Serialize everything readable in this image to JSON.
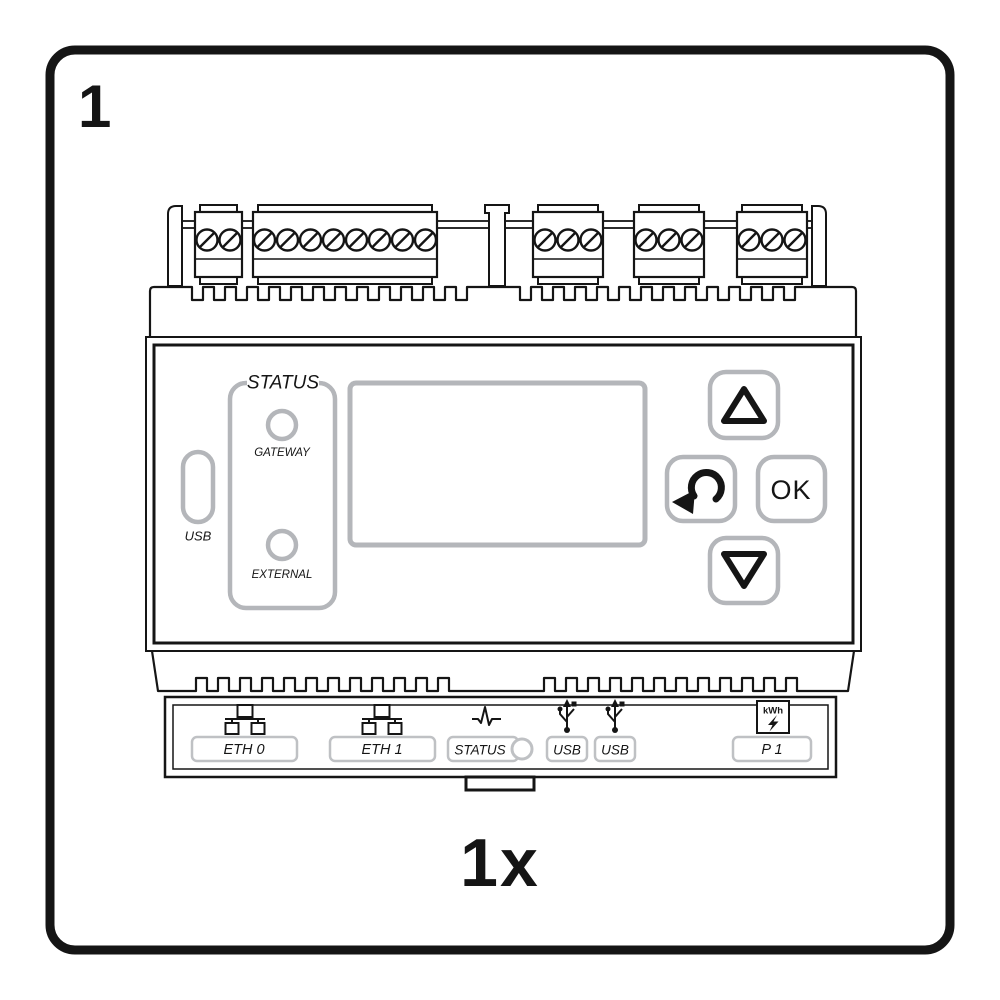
{
  "step": {
    "number": "1",
    "quantity_label": "1x"
  },
  "device": {
    "faceplate": {
      "usb_slot_label": "USB",
      "status_panel": {
        "title": "STATUS",
        "leds": [
          {
            "label": "GATEWAY"
          },
          {
            "label": "EXTERNAL"
          }
        ]
      },
      "buttons": {
        "up_icon": "triangle-up",
        "back_icon": "return-arrow",
        "ok_label": "OK",
        "down_icon": "triangle-down"
      }
    },
    "terminal_blocks": {
      "left_group_screws": [
        2,
        8
      ],
      "right_group_screws": [
        3,
        3,
        3
      ]
    },
    "ports": [
      {
        "id": "eth0",
        "icon": "ethernet-icon",
        "label": "ETH 0"
      },
      {
        "id": "eth1",
        "icon": "ethernet-icon",
        "label": "ETH 1"
      },
      {
        "id": "status",
        "icon": "pulse-icon",
        "label": "STATUS",
        "has_led": true
      },
      {
        "id": "usb1",
        "icon": "usb-icon",
        "label": "USB"
      },
      {
        "id": "usb2",
        "icon": "usb-icon",
        "label": "USB"
      },
      {
        "id": "p1",
        "icon": "kwh-meter-icon",
        "label": "P 1",
        "icon_text": "kWh"
      }
    ]
  },
  "colors": {
    "ink": "#151515",
    "outline_gray": "#b4b6ba",
    "label_box_gray": "#bfc1c4",
    "background": "#ffffff"
  }
}
